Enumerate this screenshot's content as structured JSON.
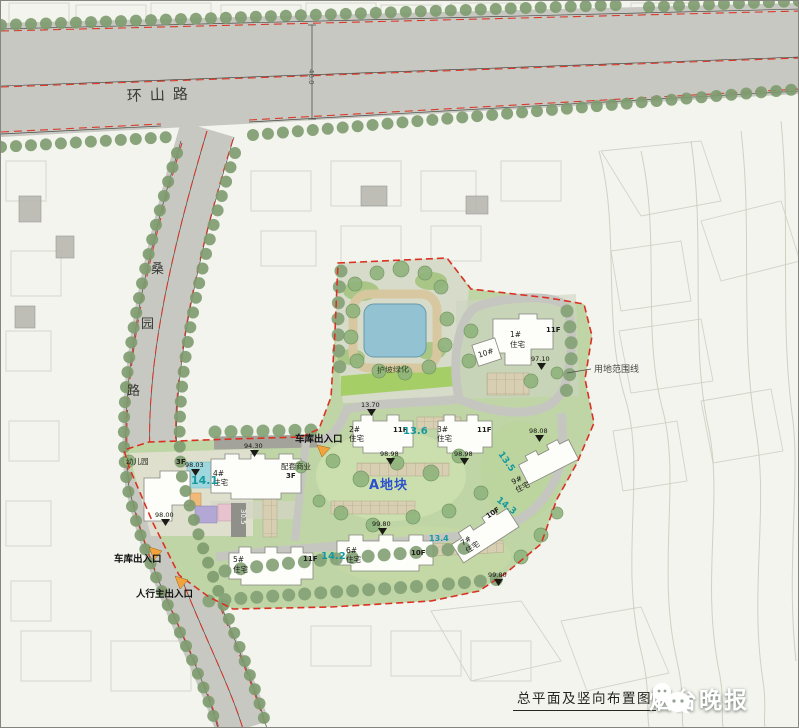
{
  "caption": {
    "title": "总平面及竖向布置图"
  },
  "watermark": {
    "source_name": "烟台晚报"
  },
  "roads": {
    "north_name": "环山路",
    "north_width": "40.0",
    "west_char_1": "桑",
    "west_char_2": "园",
    "west_char_3": "路"
  },
  "site": {
    "plot_name": "A地块",
    "boundary_label": "用地范围线",
    "slope_green": "护坡绿化",
    "retaining_dim": "30.5",
    "entrance_garage_north": "车库出入口",
    "entrance_garage_south": "车库出入口",
    "entrance_pedestrian": "人行主出入口",
    "kindergarten_name": "幼儿园",
    "kindergarten_floors": "3F",
    "commercial_name": "配套商业",
    "commercial_floors": "3F",
    "buildings": [
      {
        "no": "1#",
        "type": "住宅",
        "floors": "11F"
      },
      {
        "no": "2#",
        "type": "住宅",
        "floors": "11F"
      },
      {
        "no": "3#",
        "type": "住宅",
        "floors": "11F"
      },
      {
        "no": "4#",
        "type": "住宅",
        "floors": ""
      },
      {
        "no": "5#",
        "type": "住宅",
        "floors": "11F"
      },
      {
        "no": "6#",
        "type": "住宅",
        "floors": "10F"
      },
      {
        "no": "7#",
        "type": "住宅",
        "floors": "10F"
      },
      {
        "no": "9#",
        "type": "住宅",
        "floors": ""
      },
      {
        "no": "10#",
        "type": "住宅",
        "floors": ""
      }
    ],
    "elevations": {
      "e1": "13.70",
      "e2": "94.30",
      "e3": "98.03",
      "e4": "98.00",
      "e5": "97.10",
      "e6": "98.98",
      "e7": "98.98",
      "e8": "98.08",
      "e9": "99.80",
      "e10": "99.80"
    },
    "grades": {
      "g1": "14.1",
      "g2": "13.6",
      "g3": "13.5",
      "g4": "14.2",
      "g5": "14.3",
      "g6": "13.4"
    }
  }
}
